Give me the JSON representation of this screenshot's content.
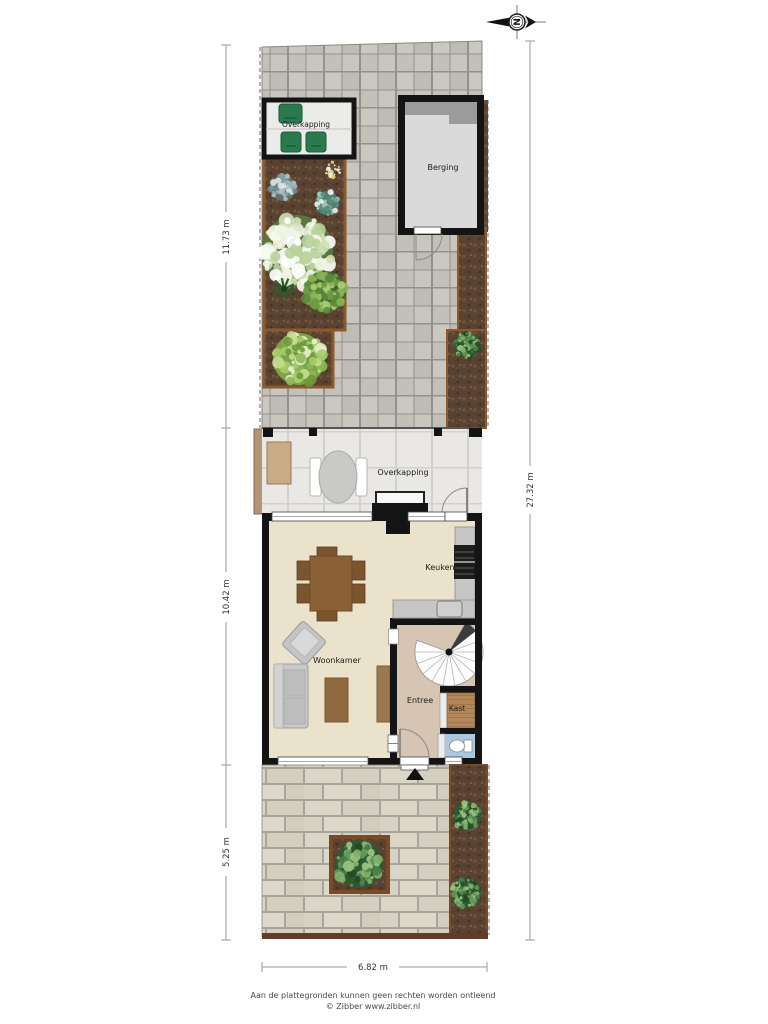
{
  "compass": {
    "letter": "N"
  },
  "labels": {
    "overkapping_top": "Overkapping",
    "berging": "Berging",
    "overkapping_mid": "Overkapping",
    "keuken": "Keuken",
    "woonkamer": "Woonkamer",
    "entree": "Entree",
    "kast": "Kast"
  },
  "dimensions": {
    "back_garden": "11.73 m",
    "house": "10.42 m",
    "front_garden": "5.25 m",
    "total": "27.32 m",
    "width": "6.82 m"
  },
  "footer": {
    "disclaimer": "Aan de plattegronden kunnen geen rechten worden ontleend",
    "credit": "© Zibber www.zibber.nl"
  },
  "colors": {
    "wall": "#141414",
    "paving": "#c6c3bc",
    "brick": "#d8d5c8",
    "soil": "#5a4231",
    "house_floor": "#ebe2cc",
    "entree_floor": "#d5c5b2",
    "kast_floor": "#b2885a",
    "toilet_floor": "#abc8e0",
    "garden_chair_green": "#2a7a4e",
    "bed_edging": "#8a5a2c"
  }
}
